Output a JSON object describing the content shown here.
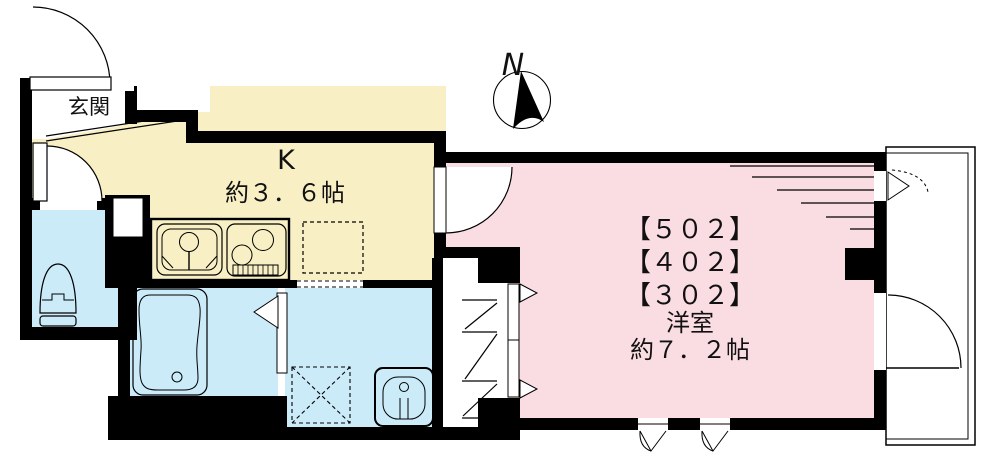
{
  "title": "apartment-floor-plan",
  "compass": {
    "label": "N"
  },
  "rooms": {
    "entrance": {
      "label": "玄関"
    },
    "kitchen": {
      "label": "K",
      "size": "約３．６帖"
    },
    "western_room": {
      "units": [
        "【５０２】",
        "【４０２】",
        "【３０２】"
      ],
      "label": "洋室",
      "size": "約７．２帖"
    }
  },
  "colors": {
    "kitchen": "#F8EFC5",
    "western_room": "#FADCE3",
    "wet_area": "#CBEBF9",
    "wall": "#000000",
    "background": "#FFFFFF"
  }
}
